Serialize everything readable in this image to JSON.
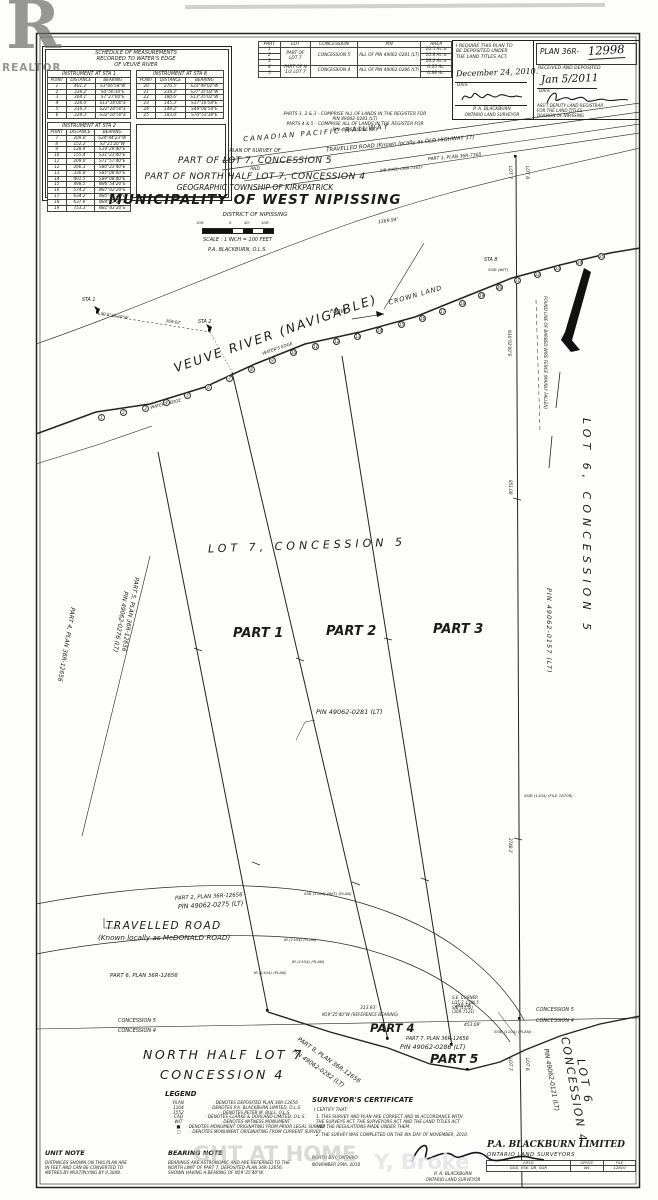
{
  "watermark": {
    "logo_letter": "R",
    "logo_caption": "REALTOR",
    "fragment_left": "GHT AT HOME",
    "fragment_right": "Y, Broke"
  },
  "schedule": {
    "title": [
      "SCHEDULE OF MEASUREMENTS",
      "RECORDED TO WATER'S EDGE",
      "OF VEUVE RIVER"
    ],
    "cols": [
      "POINT",
      "DISTANCE",
      "BEARING"
    ],
    "sta1": {
      "title": "INSTRUMENT AT STA 1",
      "rows": [
        [
          "1",
          "401.2'",
          "S3°06'58\"W"
        ],
        [
          "2",
          "338.2'",
          "S0°56'30\"E"
        ],
        [
          "3",
          "364.1'",
          "S7°27'00\"E"
        ],
        [
          "4",
          "328.0'",
          "S13°34'00\"E"
        ],
        [
          "5",
          "316.3'",
          "S22°28'50\"E"
        ],
        [
          "6",
          "324.3'",
          "S32°10'50\"E"
        ]
      ]
    },
    "sta8": {
      "title": "INSTRUMENT AT STA 8",
      "rows": [
        [
          "20",
          "270.5'",
          "S33°49'02\"W"
        ],
        [
          "21",
          "238.2'",
          "S37°35'02\"W"
        ],
        [
          "22",
          "180.6'",
          "S13°35'02\"W"
        ],
        [
          "23",
          "145.3'",
          "S17°16'58\"E"
        ],
        [
          "24",
          "149.2'",
          "S48°08'58\"E"
        ],
        [
          "25",
          "183.0'",
          "S70°51'38\"E"
        ]
      ]
    },
    "sta2": {
      "title": "INSTRUMENT AT STA 2",
      "rows": [
        [
          "7",
          "209.0'",
          "S24°44'23\"W"
        ],
        [
          "8",
          "152.2'",
          "S3°21'20\"W"
        ],
        [
          "9",
          "128.9'",
          "S19°29'40\"E"
        ],
        [
          "10",
          "155.4'",
          "S31°23'40\"E"
        ],
        [
          "11",
          "209.0'",
          "S71°57'40\"E"
        ],
        [
          "12",
          "266.3'",
          "S80°23'40\"E"
        ],
        [
          "13",
          "330.8'",
          "S85°08'00\"E"
        ],
        [
          "14",
          "401.5'",
          "S89°08'40\"E"
        ],
        [
          "15",
          "498.5'",
          "N86°54'20\"E"
        ],
        [
          "16",
          "574.2'",
          "N87°02'20\"E"
        ],
        [
          "17",
          "634.2'",
          "N85°42'20\"E"
        ],
        [
          "18",
          "637.6'",
          "N84°22'20\"E"
        ],
        [
          "19",
          "753.3'",
          "N81°43'20\"E"
        ]
      ]
    }
  },
  "parts": {
    "headers": [
      "PART",
      "LOT",
      "CONCESSION",
      "PIN",
      "AREA"
    ],
    "nums": [
      "1",
      "2",
      "3",
      "4",
      "5"
    ],
    "lot_a": "PART OF LOT 7",
    "con_a": "CONCESSION 5",
    "pin_a": "ALL OF PIN 49062-0281 (LT)",
    "lot_b": "PART OF N 1/2 LOT 7",
    "con_b": "CONCESSION 4",
    "pin_b": "ALL OF PIN 49062-0286 (LT)",
    "areas": [
      "10.5 Ac.±",
      "10.8 Ac.±",
      "16.2 Ac.±",
      "0.35 Ac.",
      "0.88 Ac."
    ],
    "notes": [
      "PARTS 1, 2 & 3 - COMPRISE ALL OF LANDS IN THE REGISTER FOR",
      "PIN 49062-0281 (LT)",
      "PARTS 4 & 5 - COMPRISE ALL OF LANDS IN THE REGISTER FOR",
      "PIN 49062-0286 (LT)"
    ]
  },
  "cert": {
    "left": {
      "lines": [
        "I REQUIRE THIS PLAN TO",
        "BE DEPOSITED UNDER",
        "THE LAND TITLES ACT."
      ],
      "date": "December 24, 2010.",
      "date_label": "DATE",
      "name": "P. A. BLACKBURN",
      "role": "ONTARIO LAND SURVEYOR"
    },
    "right": {
      "plan_prefix": "PLAN 36R-",
      "plan_number": "12998",
      "received": "RECEIVED AND DEPOSITED",
      "date": "Jan 5/2011",
      "date_label": "DATE",
      "role": [
        "ASS'T DEPUTY LAND REGISTRAR",
        "FOR THE LAND TITLES",
        "DIVISION OF NIPISSING"
      ]
    }
  },
  "title": {
    "l1": "PLAN OF SURVEY OF",
    "l2": "PART OF LOT 7, CONCESSION 5",
    "l3": "AND",
    "l4": "PART OF NORTH HALF LOT 7, CONCESSION 4",
    "l5": "GEOGRAPHIC TOWNSHIP OF KIRKPATRICK",
    "l6": "MUNICIPALITY OF WEST NIPISSING",
    "l7": "DISTRICT OF NIPISSING",
    "scale_ticks": [
      "100'",
      "0",
      "50'",
      "100'"
    ],
    "scale": "SCALE : 1 INCH = 100 FEET",
    "surveyor": "P.A. BLACKBURN, O.L.S."
  },
  "map": {
    "railway": "CANADIAN PACIFIC RAILWAY",
    "road_top": "TRAVELLED ROAD (Known locally as OLD HIGHWAY 17)",
    "road_top_ref": "PART 1, PLAN 36R-7365",
    "road_top_sib": "SIB (CAD) (36R-7365)",
    "river": "VEUVE RIVER (NAVIGABLE)",
    "flow": "FLOW",
    "crown_land": "CROWN LAND",
    "waters_edge_1": "WATER'S EDGE",
    "waters_edge_2": "WATER'S EDGE",
    "sta1": "STA 1",
    "sta2": "STA 2",
    "sta8": "STA 8",
    "bearing_sta2": "N73°26'40\"W",
    "dist_sta2": "369.02'",
    "dist_top": "1369.94'",
    "lot7_con5": "LOT 7,  CONCESSION  5",
    "part1": "PART 1",
    "part2": "PART 2",
    "part3": "PART 3",
    "pin_0281": "PIN  49062-0281  (LT)",
    "lot6_con5": "LOT 6,  CONCESSION  5",
    "pin_0157": "PIN 49062-0157 (LT)",
    "lot7_tick_top": "LOT 7",
    "lot6_tick_top": "LOT 6",
    "lot7_tick_bot": "LOT 7",
    "lot6_tick_bot": "LOT 6",
    "bearing_east": "N10°02'00\"E",
    "dist_east_1": "851.08'",
    "dist_east_2": "2748.1'",
    "fence_note": "FOUND LINE OF BARBED WIRE FENCE (MAINLY FALLEN)",
    "ssib_wit": "SSIB (WIT)",
    "ssib_file": "SSIB (1104) (FILE 18706)",
    "part5_plan": "PART 5, PLAN 36R-12656",
    "pin_0276": "PIN 49062-0276 (LT)",
    "part4_plan": "PART 4, PLAN 36R-12656",
    "part2_plan": "PART 2, PLAN 36R-12656",
    "pin_0275": "PIN 49062-0275 (LT)",
    "road_bottom_1": "TRAVELLED ROAD",
    "road_bottom_2": "(Known locally as McDONALD ROAD)",
    "part6_plan": "PART 6, PLAN 36R-12656",
    "con5_left": "CONCESSION 5",
    "con4_left": "CONCESSION 4",
    "con5_right": "CONCESSION 5",
    "con4_right": "CONCESSION 4",
    "north_half_1": "NORTH HALF LOT 7",
    "north_half_2": "CONCESSION 4",
    "part4": "PART 4",
    "part5": "PART 5",
    "part7_plan": "PART 7, PLAN 36R-12656",
    "pin_0286": "PIN  49062-0286  (LT)",
    "part8_plan": "PART 8, PLAN 36R-12656",
    "pin_0282": "PIN 49062-0282 (LT)",
    "lot6_c4_lot": "LOT 6",
    "lot6_c4_con": "CONCESSION 4",
    "pin_0121": "PIN 49062-0121 (LT)",
    "se_corner": [
      "S.E. CORNER",
      "LOT 7, CON 5",
      "SIB (1552)",
      "(36R-7121)"
    ],
    "ref_bearing": "N59°25'40\"W (REFERENCE BEARING)",
    "dist_313": "313.93'",
    "dist_240": "240.74'",
    "dist_453": "453.09'",
    "mon_1": "SSB (1104) (WIT) (PLAN)",
    "mon_2": "IB (1104) (PLAN)",
    "mon_3": "IB (1104) (PLAN)",
    "mon_4": "IB (1104) (PLAN)",
    "mon_5": "SSIB (1104) (PLAN)",
    "point_numbers": [
      "1",
      "2",
      "3",
      "4",
      "5",
      "6",
      "7",
      "8",
      "9",
      "10",
      "11",
      "12",
      "13",
      "14",
      "15",
      "16",
      "17",
      "18",
      "19",
      "20",
      "21",
      "22",
      "23",
      "24",
      "25"
    ]
  },
  "legend": {
    "title": "LEGEND",
    "rows": [
      [
        "PLAN",
        "- DENOTES DEPOSITED PLAN 36R-12656"
      ],
      [
        "1104",
        "- DENOTES P.A. BLACKBURN LIMITED, O.L.S."
      ],
      [
        "1552",
        "- DENOTES PETER M. BULL, O.L.S."
      ],
      [
        "CAD",
        "- DENOTES CLARKE & DORLAND LIMITED, O.L.S."
      ],
      [
        "WIT",
        "- DENOTES WITNESS MONUMENT"
      ],
      [
        "■",
        "- DENOTES MONUMENT ORIGINATING FROM PRIOR LEGAL SURVEY"
      ],
      [
        "□",
        "- DENOTES MONUMENT ORIGINATING FROM CURRENT SURVEY"
      ]
    ]
  },
  "notes": {
    "unit_title": "UNIT NOTE",
    "unit_lines": [
      "DISTANCES SHOWN ON THIS PLAN ARE",
      "IN FEET AND CAN BE CONVERTED TO",
      "METRES BY MULTIPLYING BY 0.3048."
    ],
    "bearing_title": "BEARING NOTE",
    "bearing_lines": [
      "BEARINGS ARE ASTRONOMIC AND ARE REFERRED TO THE",
      "NORTH LIMIT OF PART 7, DEPOSITED PLAN 36R-12656,",
      "SHOWN HAVING A BEARING OF N59°25'40\"W."
    ]
  },
  "surveyor_cert": {
    "title": "SURVEYOR'S CERTIFICATE",
    "intro": "I CERTIFY THAT:",
    "lines": [
      "1. THIS SURVEY AND PLAN ARE CORRECT AND IN ACCORDANCE WITH",
      "    THE SURVEYS ACT, THE SURVEYORS ACT AND THE LAND TITLES ACT",
      "    AND THE REGULATIONS MADE UNDER THEM.",
      "2. THE SURVEY WAS COMPLETED ON THE 8th DAY OF NOVEMBER, 2010."
    ],
    "place": "NORTH BAY, ONTARIO",
    "date": "NOVEMBER 29th, 2010",
    "name": "P. A. BLACKBURN",
    "role": "ONTARIO LAND SURVEYOR"
  },
  "company": {
    "name": "P.A. BLACKBURN LIMITED",
    "sub": "ONTARIO LAND SURVEYORS",
    "table": [
      [
        "FIELD",
        "OFFICE",
        "FILE"
      ],
      [
        "GGS, ESK, DR, SGR",
        "WL",
        "12810"
      ]
    ]
  }
}
